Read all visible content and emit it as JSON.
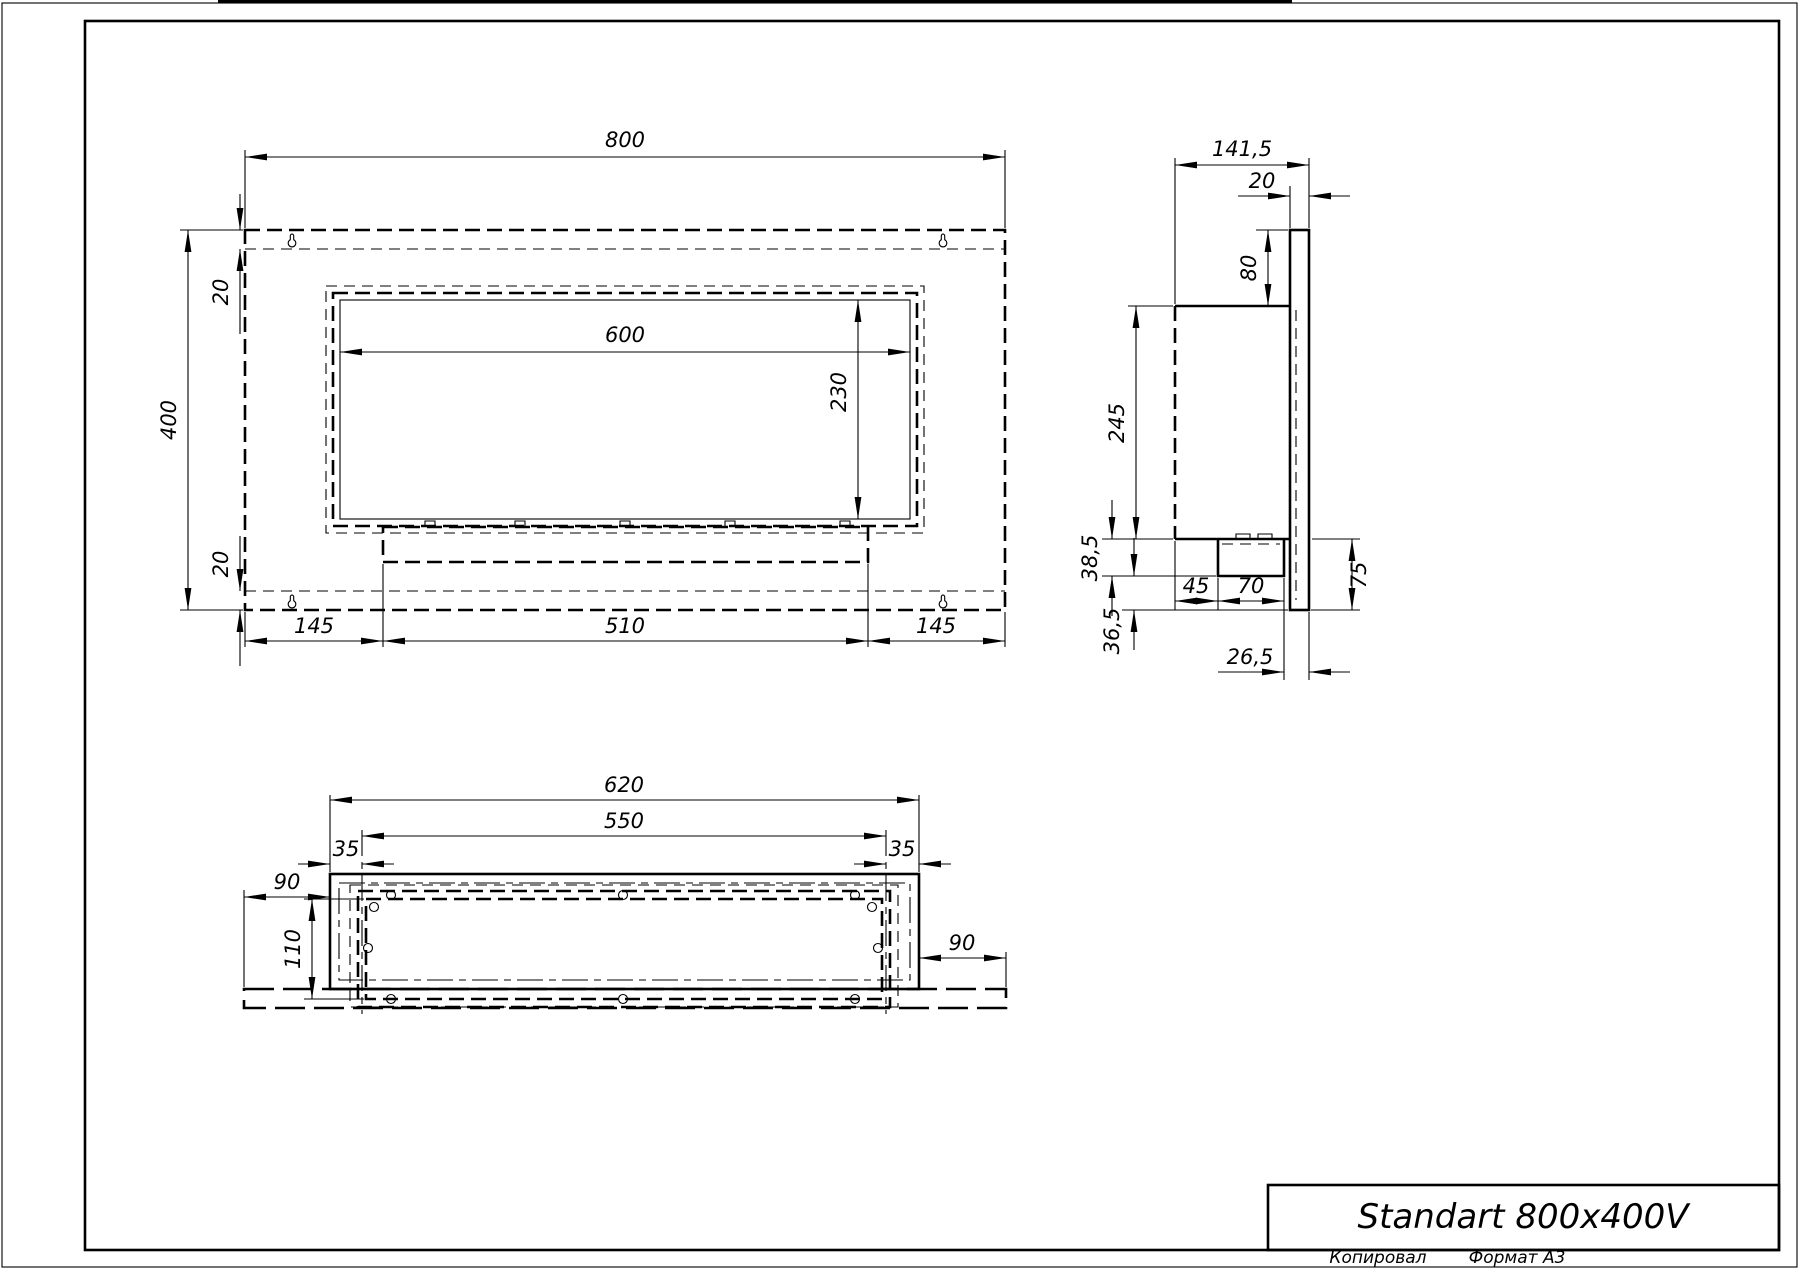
{
  "drawing": {
    "front_view": {
      "width": "800",
      "height": "400",
      "top_inset": "20",
      "bottom_inset": "20",
      "opening_width": "600",
      "opening_height": "230",
      "bottom_left": "145",
      "bottom_center": "510",
      "bottom_right": "145"
    },
    "side_view": {
      "depth": "141,5",
      "panel_thickness": "20",
      "top_offset": "80",
      "body_height": "245",
      "lower_height": "38,5",
      "bottom_gap": "36,5",
      "burner_offset": "45",
      "burner_width": "70",
      "rear_offset": "26,5",
      "front_drop": "75"
    },
    "bottom_view": {
      "body_width": "620",
      "opening_width": "550",
      "inset_left": "35",
      "inset_right": "35",
      "flange_left": "90",
      "flange_right": "90",
      "opening_depth": "110"
    },
    "title_block": {
      "title": "Standart 800x400V"
    },
    "footer": {
      "copied_label": "Копировал",
      "format_label": "Формат А3"
    }
  }
}
